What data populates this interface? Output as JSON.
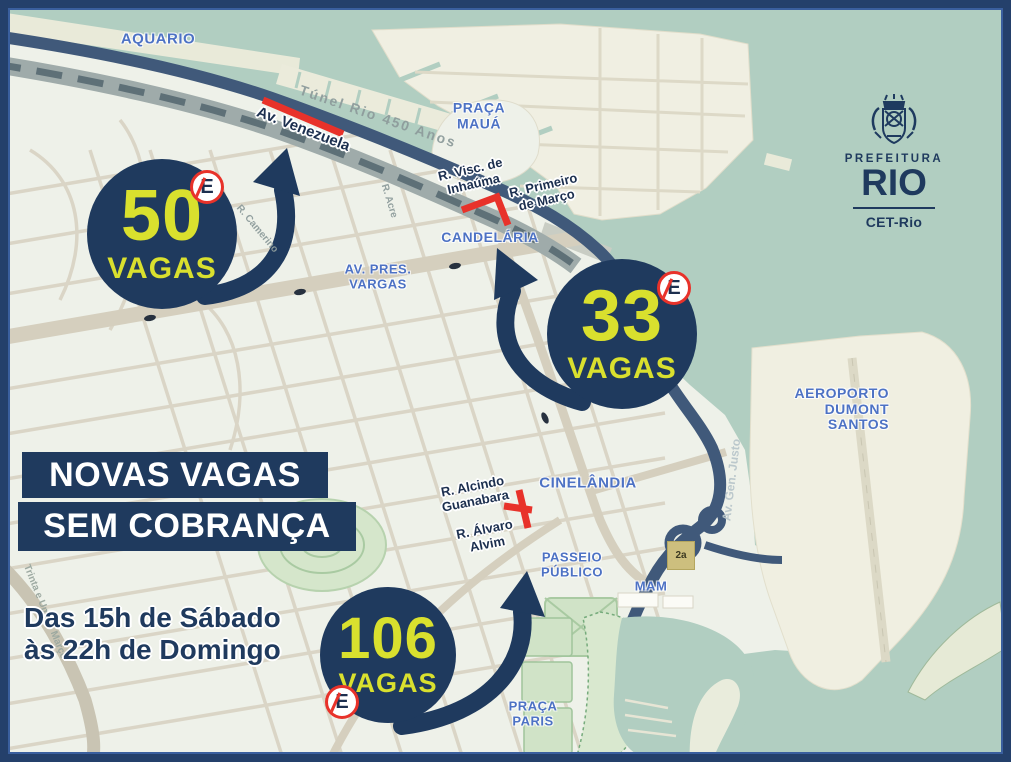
{
  "colors": {
    "navy": "#1f3a5e",
    "frame": "#24406b",
    "frame_inner": "#3a5f9e",
    "yellow": "#d9e02e",
    "red": "#e8322a",
    "water": "#b1cec1",
    "land": "#eef1e9",
    "cream": "#f0efe1",
    "street": "#d9d4c5",
    "label_blue": "#4d72c4",
    "label_dark": "#1c2f4f",
    "road_navy": "#40597a",
    "park": "#d3e4ca"
  },
  "headline": {
    "line1": "NOVAS VAGAS",
    "line2": "SEM COBRANÇA"
  },
  "schedule": {
    "line1": "Das 15h de Sábado",
    "line2": "às 22h de Domingo"
  },
  "logo": {
    "org": "PREFEITURA",
    "city": "RIO",
    "dept": "CET-Rio"
  },
  "sign_letter": "E",
  "spots": [
    {
      "count": "50",
      "unit": "VAGAS"
    },
    {
      "count": "33",
      "unit": "VAGAS"
    },
    {
      "count": "106",
      "unit": "VAGAS"
    }
  ],
  "places": {
    "aquario": "AQUARIO",
    "praca_maua": "PRAÇA\nMAUÁ",
    "candelaria": "CANDELÁRIA",
    "av_pres_vargas": "AV. PRES.\nVARGAS",
    "cinelandia": "CINELÂNDIA",
    "passeio_publico": "PASSEIO\nPÚBLICO",
    "mam": "MAM",
    "aeroporto": "AEROPORTO\nDUMONT\nSANTOS",
    "praca_paris": "PRAÇA\nPARIS"
  },
  "streets": {
    "av_venezuela": "Av. Venezuela",
    "visc_inhauma": "R. Visc. de\nInhaúma",
    "primeiro_marco": "R. Primeiro\nde Março",
    "alcindo_guanabara": "R. Alcindo\nGuanabara",
    "alvaro_alvim": "R. Álvaro\nAlvim"
  },
  "base_map": {
    "tunel": "Túnel Rio 450 Anos",
    "r_acre": "R. Acre",
    "r_camerino": "R. Camerino",
    "gen_justo": "Av. Gen. Justo",
    "trinta": "Trinta e Um de Março",
    "marker": "2a"
  }
}
